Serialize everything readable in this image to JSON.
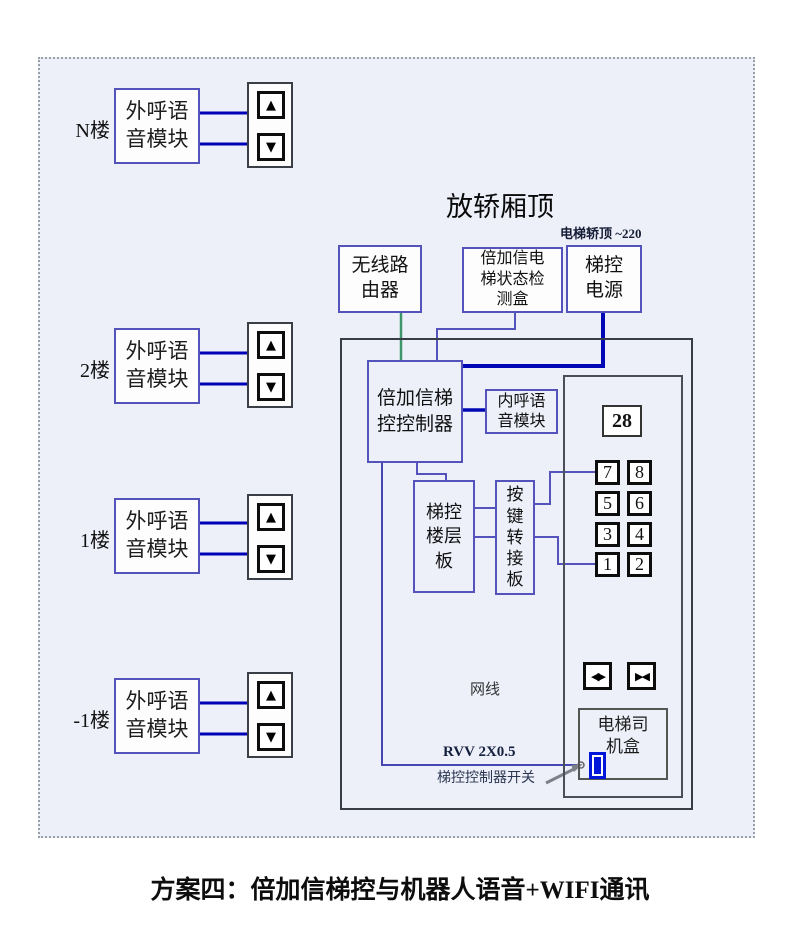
{
  "page": {
    "caption": "方案四：倍加信梯控与机器人语音+WIFI通讯"
  },
  "diagram": {
    "title": "放轿厢顶",
    "power_note": "电梯轿顶 ~220",
    "floors": [
      {
        "label": "N楼",
        "line1": "外呼语",
        "line2": "音模块"
      },
      {
        "label": "2楼",
        "line1": "外呼语",
        "line2": "音模块"
      },
      {
        "label": "1楼",
        "line1": "外呼语",
        "line2": "音模块"
      },
      {
        "label": "-1楼",
        "line1": "外呼语",
        "line2": "音模块"
      }
    ],
    "router": {
      "line1": "无线路",
      "line2": "由器"
    },
    "detector": {
      "line1": "倍加信电",
      "line2": "梯状态检",
      "line3": "测盒"
    },
    "power": {
      "line1": "梯控",
      "line2": "电源"
    },
    "controller": {
      "line1": "倍加信梯",
      "line2": "控控制器"
    },
    "inner_voice": {
      "line1": "内呼语",
      "line2": "音模块"
    },
    "floor_board": {
      "line1": "梯控",
      "line2": "楼层",
      "line3": "板"
    },
    "key_adapter": {
      "c1": "按",
      "c2": "键",
      "c3": "转",
      "c4": "接",
      "c5": "板"
    },
    "driver_box": {
      "line1": "电梯司",
      "line2": "机盒"
    },
    "panel": {
      "display": "28",
      "keys": [
        "7",
        "8",
        "5",
        "6",
        "3",
        "4",
        "1",
        "2"
      ]
    },
    "labels": {
      "network": "网线",
      "rvv": "RVV 2X0.5",
      "switch": "梯控控制器开关"
    },
    "icons": {
      "up_arrow": "▲",
      "down_arrow": "▼",
      "open_door": "◀▶",
      "close_door": "▶◀"
    },
    "colors": {
      "wire_dark_blue": "#0000b8",
      "wire_green": "#3c9668",
      "wire_violet": "#5353bb",
      "switch_blue": "#0016d8",
      "frame_background": "#edf0f9"
    }
  }
}
